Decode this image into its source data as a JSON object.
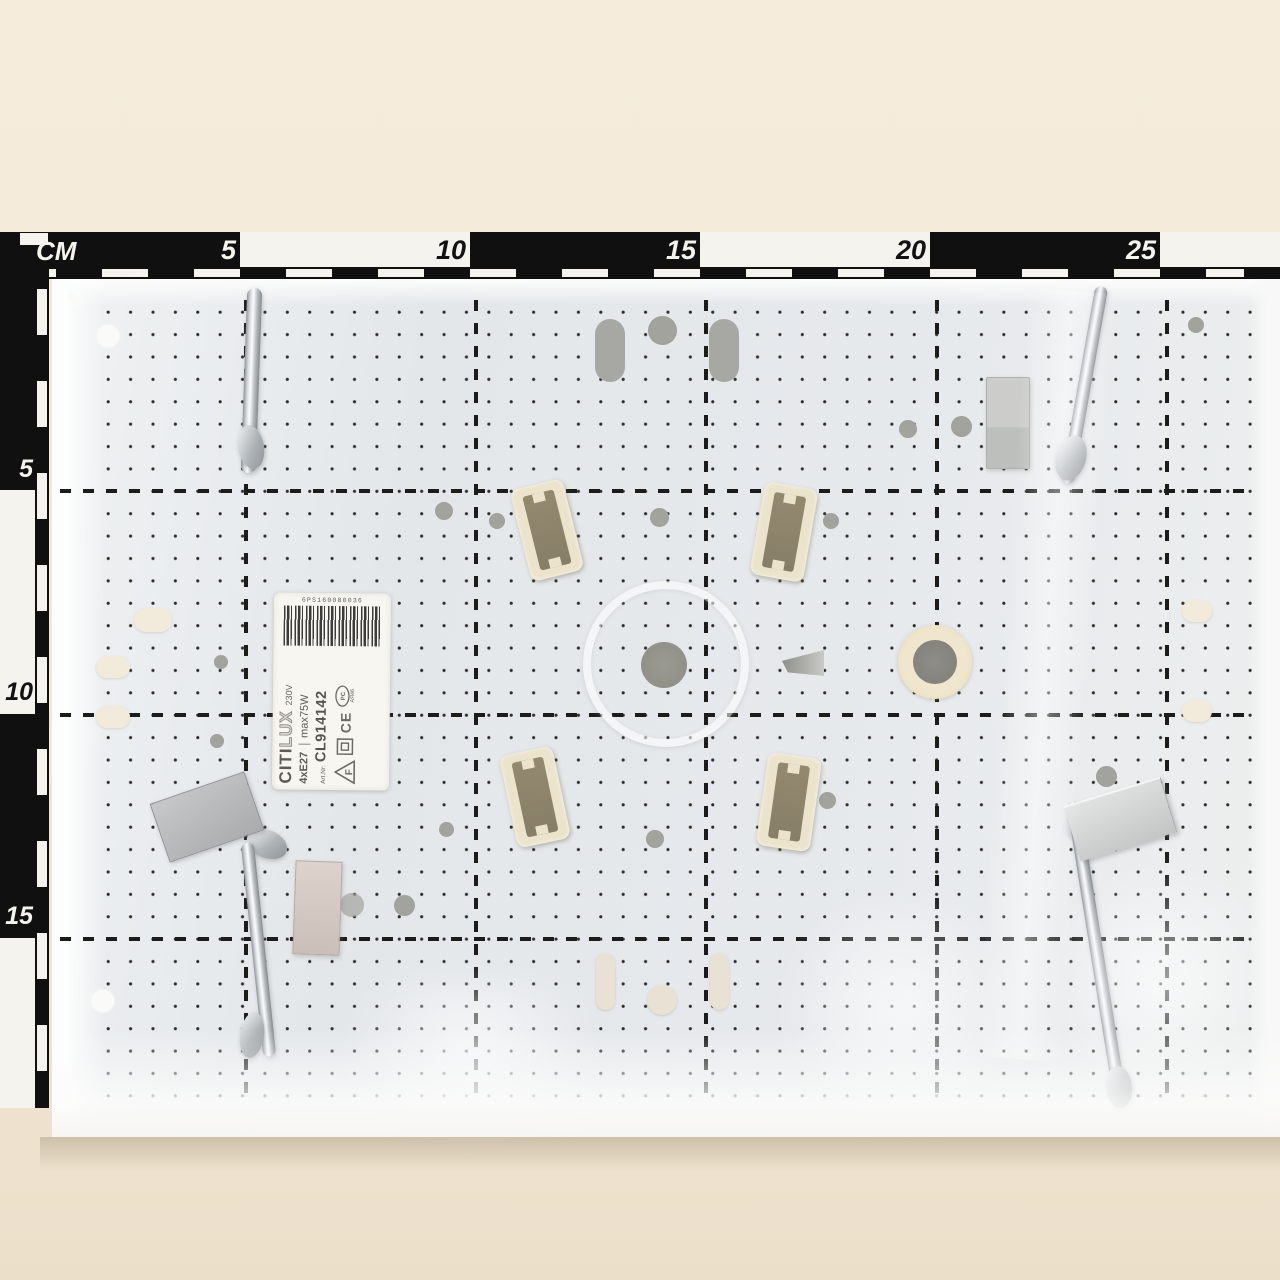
{
  "scale_bar": {
    "unit": "CM",
    "top_marks": [
      "5",
      "10",
      "15",
      "20",
      "25"
    ],
    "left_marks": [
      "5",
      "10",
      "15"
    ]
  },
  "product_label": {
    "barcode_digits": "6PS160080036",
    "brand_part1": "CITI",
    "brand_part2": "LUX",
    "voltage": "230V",
    "socket_spec": "4xE27",
    "power_spec": "max75W",
    "art_prefix": "Art.Nr:",
    "art_number": "CL914142",
    "mark_f": "F",
    "mark_ce": "CE",
    "mark_pct": "PCT",
    "mark_cert": "АЯ46"
  },
  "colors": {
    "backdrop": "#f3e9d8",
    "ruler_dark": "#101010",
    "ruler_light": "#f5f3ee",
    "panel": "#e7eaec",
    "bone": "#ebe3cb"
  }
}
